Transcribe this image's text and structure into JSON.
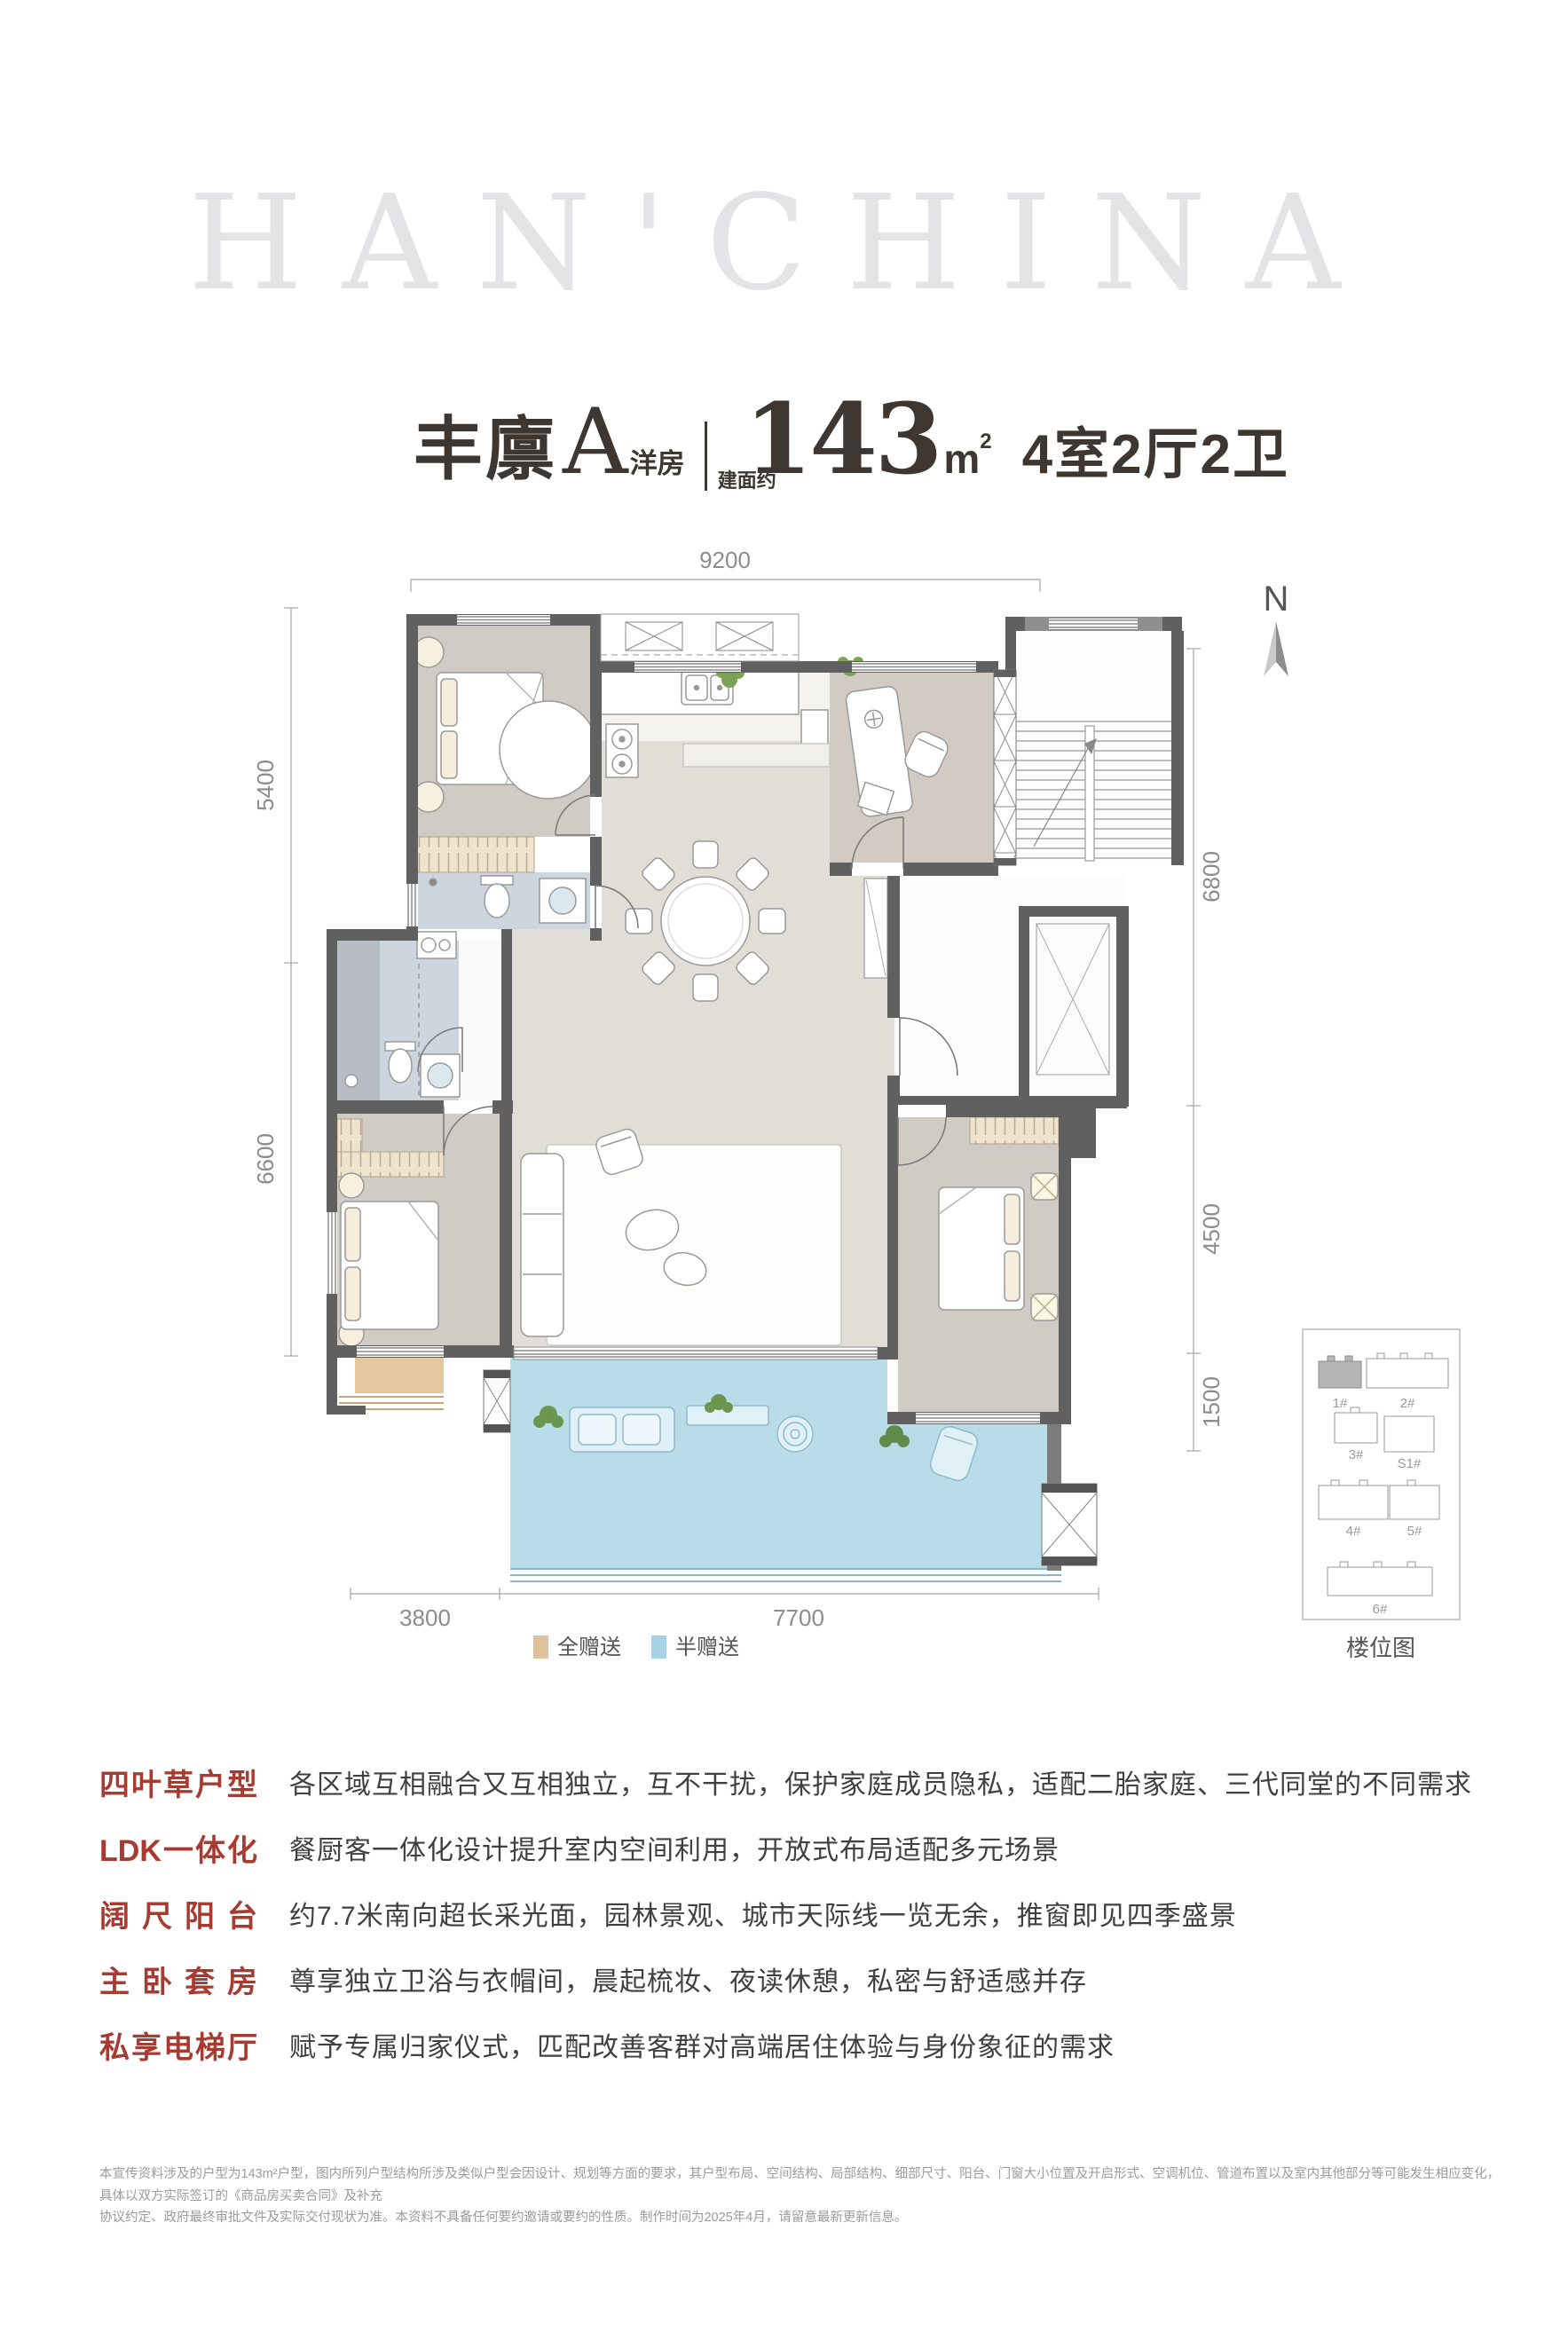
{
  "watermark": "HAN'CHINA",
  "title": {
    "name": "丰廪",
    "type_letter": "A",
    "type_suffix": "洋房",
    "area_prefix": "建面约",
    "area_value": "143",
    "area_unit_base": "m",
    "area_unit_sup": "2",
    "layout": "4室2厅2卫"
  },
  "compass": {
    "label": "N"
  },
  "plan": {
    "dims": {
      "top": "9200",
      "left_upper": "5400",
      "left_lower": "6600",
      "right_upper": "6800",
      "right_middle": "4500",
      "right_lower": "1500",
      "bottom_left": "3800",
      "bottom_right": "7700"
    }
  },
  "legend": {
    "full_gift": {
      "label": "全赠送",
      "color": "#dfc19c"
    },
    "half_gift": {
      "label": "半赠送",
      "color": "#a7d2e3"
    }
  },
  "site_map": {
    "caption": "楼位图",
    "buildings": [
      "1#",
      "2#",
      "3#",
      "S1#",
      "4#",
      "5#",
      "6#"
    ]
  },
  "features": [
    {
      "label": "四叶草户型",
      "desc": "各区域互相融合又互相独立，互不干扰，保护家庭成员隐私，适配二胎家庭、三代同堂的不同需求"
    },
    {
      "label": "LDK一体化",
      "desc": "餐厨客一体化设计提升室内空间利用，开放式布局适配多元场景"
    },
    {
      "label": "阔尺阳台",
      "desc": "约7.7米南向超长采光面，园林景观、城市天际线一览无余，推窗即见四季盛景"
    },
    {
      "label": "主卧套房",
      "desc": "尊享独立卫浴与衣帽间，晨起梳妆、夜读休憩，私密与舒适感并存"
    },
    {
      "label": "私享电梯厅",
      "desc": "赋予专属归家仪式，匹配改善客群对高端居住体验与身份象征的需求"
    }
  ],
  "disclaimer": {
    "line1": "本宣传资料涉及的户型为143m²户型，图内所列户型结构所涉及类似户型会因设计、规划等方面的要求，其户型布局、空间结构、局部结构、细部尺寸、阳台、门窗大小位置及开启形式、空调机位、管道布置以及室内其他部分等可能发生相应变化，具体以双方实际签订的《商品房买卖合同》及补充",
    "line2": "协议约定、政府最终审批文件及实际交付现状为准。本资料不具备任何要约邀请或要约的性质。制作时间为2025年4月，请留意最新更新信息。"
  },
  "colors": {
    "accent_red": "#a73b32",
    "title_ink": "#3e3731",
    "wall": "#606060",
    "bedroom_floor": "#d1cbc5",
    "ldk_floor": "#e1ded7",
    "bath_floor": "#cdd5de",
    "balcony": "#b9dce9",
    "full_gift": "#e4c6a0",
    "watermark": "#e4e4e6"
  }
}
